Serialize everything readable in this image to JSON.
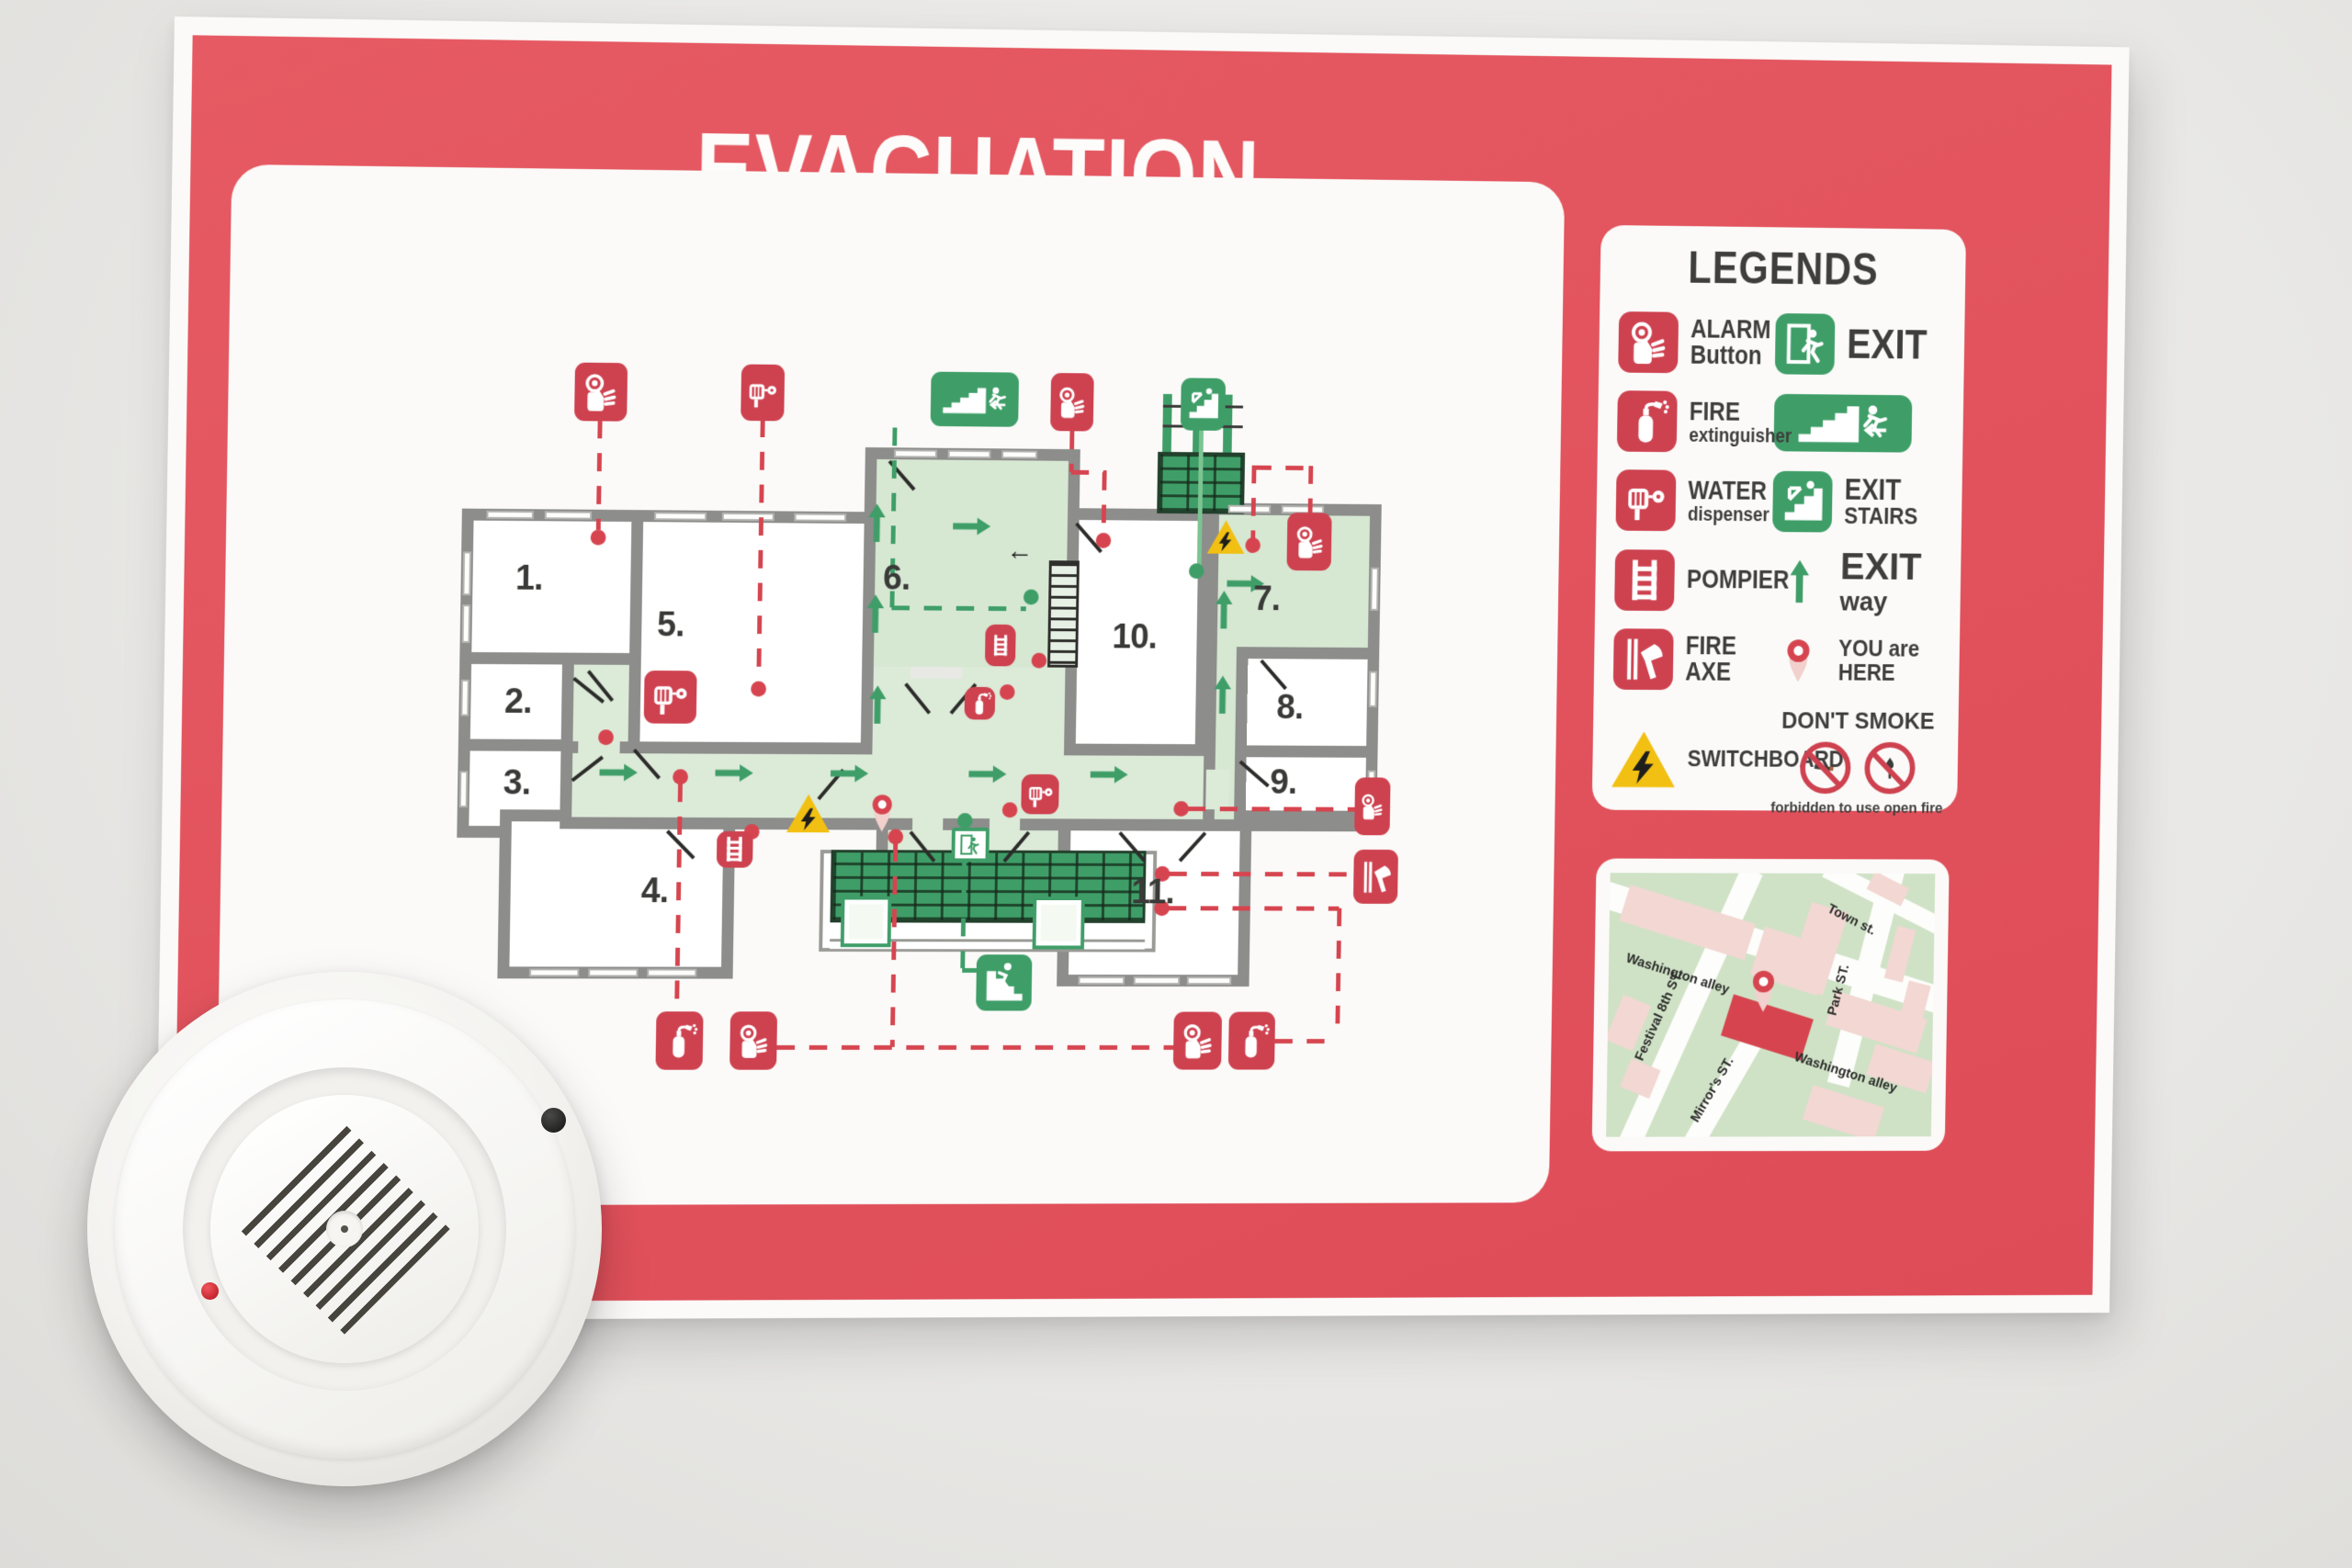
{
  "poster": {
    "title": "EVACUATION PLAN"
  },
  "legends": {
    "title": "LEGENDS",
    "alarm_line1": "ALARM",
    "alarm_line2": "Button",
    "exit": "EXIT",
    "fire_line1": "FIRE",
    "fire_line2": "extinguisher",
    "water_line1": "WATER",
    "water_line2": "dispenser",
    "exit_stairs_line1": "EXIT",
    "exit_stairs_line2": "STAIRS",
    "pompier": "POMPIER",
    "exit_way_bold": "EXIT",
    "exit_way_rest": " way",
    "fire_axe": "FIRE AXE",
    "you_are_here": "YOU are HERE",
    "switchboard": "SWITCHBOARD",
    "dont_smoke": "DON'T SMOKE",
    "forbidden": "forbidden to use open fire"
  },
  "plan": {
    "rooms": [
      "1.",
      "2.",
      "3.",
      "4.",
      "5.",
      "6.",
      "7.",
      "8.",
      "9.",
      "10.",
      "11."
    ]
  },
  "map": {
    "streets": {
      "washington1": "Washington alley",
      "washington2": "Washington alley",
      "festival": "Festival 8th ST.",
      "park": "Park ST.",
      "town": "Town st.",
      "mirrors": "Mirror's ST."
    }
  },
  "icon_names": [
    "alarm-button-icon",
    "fire-extinguisher-icon",
    "water-dispenser-icon",
    "pompier-ladder-icon",
    "fire-axe-icon",
    "switchboard-icon",
    "exit-icon",
    "exit-stairs-icon",
    "exit-stairs-down-icon",
    "exit-way-arrow-icon",
    "you-are-here-pin-icon",
    "no-smoking-icon",
    "no-open-fire-icon"
  ],
  "colors": {
    "poster_red": "#e2525c",
    "icon_red": "#ce4250",
    "sign_green": "#3f9e68",
    "floor_green": "#dcead8",
    "wall_gray": "#8d8d8b",
    "warning_yellow": "#f2c012",
    "text_dark": "#3e3e3c"
  }
}
